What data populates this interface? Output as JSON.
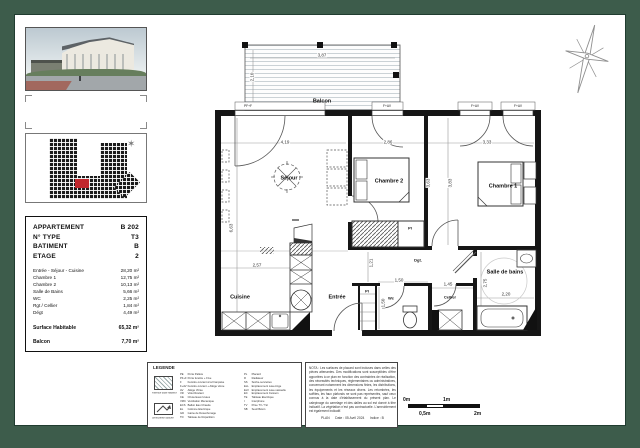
{
  "sheet": {
    "frame_color": "#3d5c4b",
    "highlight_color": "#c0272d"
  },
  "info_table": {
    "header_rows": [
      {
        "label": "APPARTEMENT",
        "value": "B 202"
      },
      {
        "label": "N° TYPE",
        "value": "T3"
      },
      {
        "label": "BATIMENT",
        "value": "B"
      },
      {
        "label": "ETAGE",
        "value": "2"
      }
    ],
    "area_rows": [
      {
        "label": "Entrée - Séjour - Cuisine",
        "value": "28,20 m²"
      },
      {
        "label": "Chambre 1",
        "value": "12,75 m²"
      },
      {
        "label": "Chambre 2",
        "value": "10,13 m²"
      },
      {
        "label": "Salle de Bains",
        "value": "5,66 m²"
      },
      {
        "label": "WC",
        "value": "2,25 m²"
      },
      {
        "label": "Rgt / Cellier",
        "value": "1,84 m²"
      },
      {
        "label": "Dégt",
        "value": "4,49 m²"
      }
    ],
    "summary_rows": [
      {
        "label": "Surface Habitable",
        "value": "65,32 m²"
      },
      {
        "label": "Balcon",
        "value": "7,70 m²"
      }
    ]
  },
  "floor_plan": {
    "room_labels": [
      {
        "text": "Balcon",
        "x": 322,
        "y": 101
      },
      {
        "text": "Séjour",
        "x": 289,
        "y": 178
      },
      {
        "text": "Chambre 2",
        "x": 389,
        "y": 181
      },
      {
        "text": "Chambre 1",
        "x": 503,
        "y": 186
      },
      {
        "text": "Cuisine",
        "x": 240,
        "y": 297
      },
      {
        "text": "Entrée",
        "x": 337,
        "y": 297
      },
      {
        "text": "Wc",
        "x": 391,
        "y": 298,
        "small": true
      },
      {
        "text": "Pl",
        "x": 367,
        "y": 291,
        "small": true
      },
      {
        "text": "Pl",
        "x": 410,
        "y": 228,
        "small": true
      },
      {
        "text": "Dgt.",
        "x": 418,
        "y": 260,
        "small": true
      },
      {
        "text": "Cellier",
        "x": 450,
        "y": 297,
        "small": true
      },
      {
        "text": "Salle de bains",
        "x": 505,
        "y": 272
      }
    ],
    "dim_labels": [
      {
        "text": "3,87",
        "x": 322,
        "y": 55
      },
      {
        "text": "2,10",
        "x": 252,
        "y": 77,
        "v": true
      },
      {
        "text": "4,19",
        "x": 285,
        "y": 142
      },
      {
        "text": "2,86",
        "x": 388,
        "y": 142
      },
      {
        "text": "3,33",
        "x": 487,
        "y": 142
      },
      {
        "text": "6,63",
        "x": 231,
        "y": 228,
        "v": true
      },
      {
        "text": "3,63",
        "x": 428,
        "y": 183,
        "v": true
      },
      {
        "text": "3,83",
        "x": 450,
        "y": 183,
        "v": true
      },
      {
        "text": "2,57",
        "x": 257,
        "y": 265
      },
      {
        "text": "1,21",
        "x": 371,
        "y": 263,
        "v": true
      },
      {
        "text": "1,50",
        "x": 399,
        "y": 280
      },
      {
        "text": "1,50",
        "x": 383,
        "y": 303,
        "v": true
      },
      {
        "text": "1,45",
        "x": 448,
        "y": 284
      },
      {
        "text": "2,20",
        "x": 506,
        "y": 294
      },
      {
        "text": "2,75",
        "x": 485,
        "y": 283,
        "v": true
      }
    ],
    "window_labels": [
      {
        "text": "PF+F",
        "x": 248,
        "y": 106
      },
      {
        "text": "F+AV",
        "x": 387,
        "y": 106
      },
      {
        "text": "F+AV",
        "x": 475,
        "y": 106
      },
      {
        "text": "F+AV",
        "x": 518,
        "y": 106
      }
    ]
  },
  "legend": {
    "title": "LEGENDE",
    "swatch1_caption": "Faïence toute hauteur",
    "swatch2_caption": "Sens pente douche",
    "col1": [
      {
        "abbr": "PE",
        "label": "Porte Palière"
      },
      {
        "abbr": "PF+F",
        "label": "Porte fenêtre + Fixe"
      },
      {
        "abbr": "F",
        "label": "Fenêtre ouvrant à la Française"
      },
      {
        "abbr": "F+AV",
        "label": "Fenêtre ouvrant + Allège vitrée"
      },
      {
        "abbr": "AV",
        "label": "Allège Vitrée"
      },
      {
        "abbr": "VR",
        "label": "Volet Roulant"
      },
      {
        "abbr": "CE",
        "label": "Chute Eaux Usées"
      },
      {
        "abbr": "VMC",
        "label": "Ventilation Mécanique"
      },
      {
        "abbr": "ECS",
        "label": "Ballon Eau Chaude"
      },
      {
        "abbr": "EL",
        "label": "Colonne Electrique"
      },
      {
        "abbr": "GD",
        "label": "Gaine de Désenfumage"
      },
      {
        "abbr": "TD",
        "label": "Tableau de Répartition"
      }
    ],
    "col2": [
      {
        "abbr": "PL",
        "label": "Placard"
      },
      {
        "abbr": "R",
        "label": "Radiateur"
      },
      {
        "abbr": "SS",
        "label": "Sèche-serviettes"
      },
      {
        "abbr": "ELL",
        "label": "Emplacement Lave-linge"
      },
      {
        "abbr": "ELV",
        "label": "Emplacement Lave-vaisselle"
      },
      {
        "abbr": "EC",
        "label": "Emplacement Cuisson"
      },
      {
        "abbr": "TE",
        "label": "Tableau Electrique"
      },
      {
        "abbr": "I",
        "label": "Interphone"
      },
      {
        "abbr": "TV",
        "label": "Prise TV / Tél"
      },
      {
        "abbr": "SB",
        "label": "Seuil Béton"
      }
    ]
  },
  "nota": {
    "text": "NOTA : Les surfaces de placard sont incluses dans celles des pièces attenantes. Des modifications sont susceptibles d'être apportées à ce plan en fonction des contraintes de réalisation, des nécessités techniques, réglementaires ou administratives, concernant notamment les dimensions finies, les distributions, les équipements et les réseaux divers. Les retombées, les soffites, les faux plafonds ne sont pas représentés, sauf ceux connus à la date d'établissement du présent plan. Le calepinage du carrelage et des dalles au sol est donné à titre indicatif. La végétation n'est pas contractuelle. L'ameublement est également indicatif.",
    "footer_plan": "PLAN",
    "footer_date": "Date : 05 Avril 2024",
    "footer_indice": "Indice : B"
  },
  "scale_bar": {
    "l0": "0m",
    "l05": "0,5m",
    "l1": "1m",
    "l2": "2m"
  }
}
